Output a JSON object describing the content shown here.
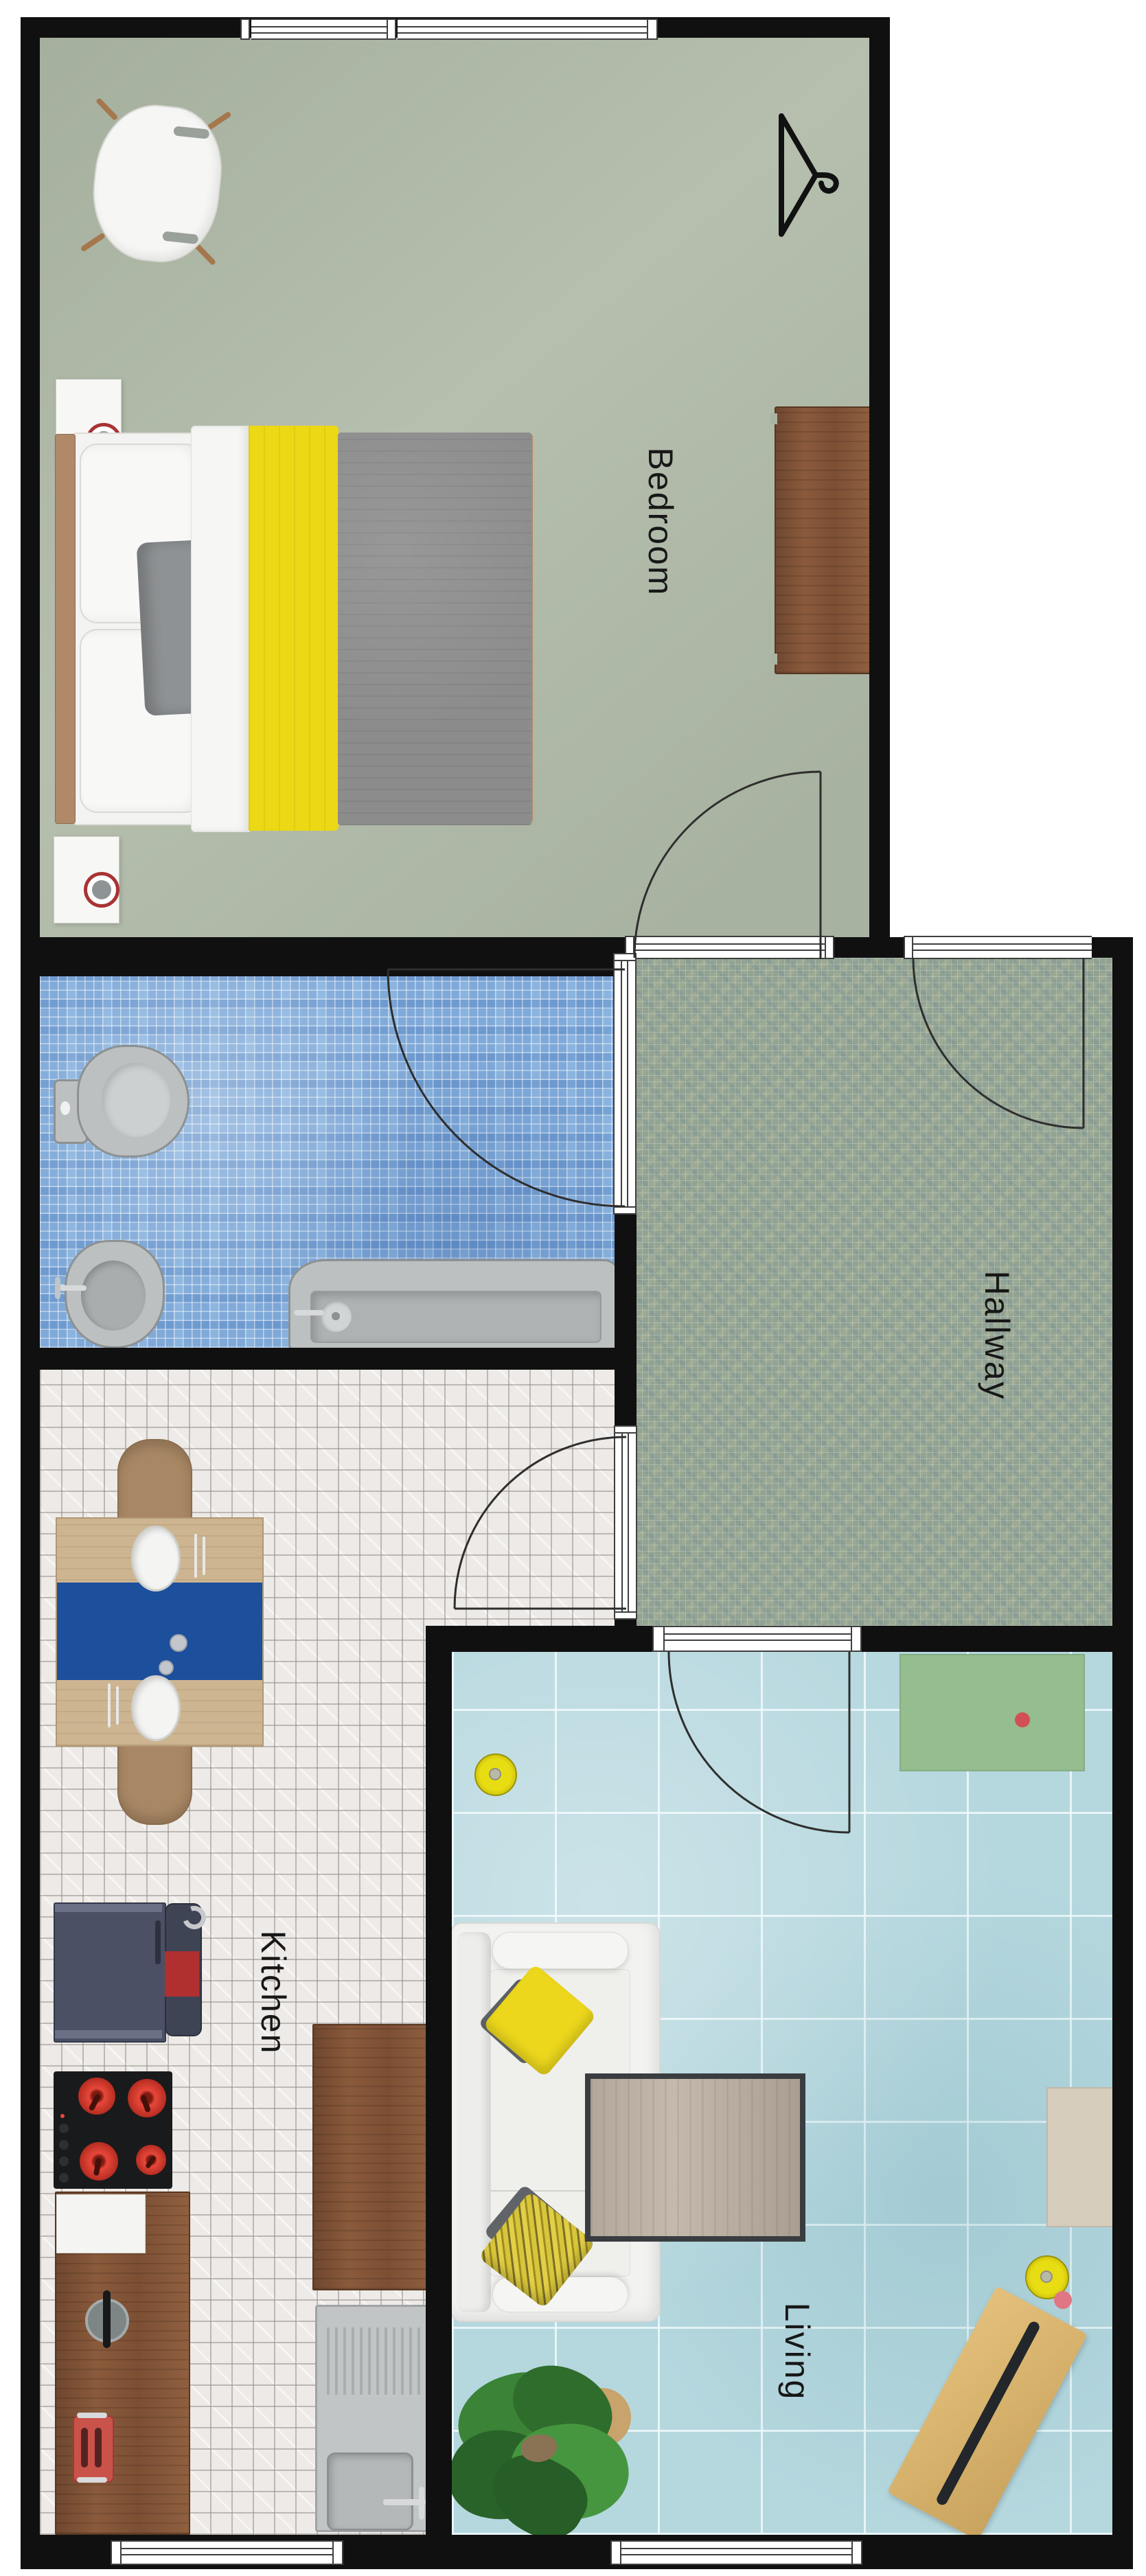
{
  "rooms": {
    "bedroom": {
      "label": "Bedroom"
    },
    "hallway": {
      "label": "Hallway"
    },
    "kitchen": {
      "label": "Kitchen"
    },
    "living": {
      "label": "Living"
    }
  },
  "colors": {
    "wall": "#101010",
    "bedroom_floor": "#aab3a1",
    "bathroom_floor": "#7fa9d8",
    "hallway_floor": "#93a392",
    "kitchen_floor": "#edeae7",
    "living_floor": "#b5d7de",
    "accent_yellow": "#ecd814",
    "runner_blue": "#1c4f9c",
    "sideboard_green": "#95bd90",
    "appliance_red": "#d94436",
    "sofa_white": "#f2f2f0",
    "wood_brown": "#8a5a3b",
    "duvet_gray": "#8c8c8c"
  }
}
